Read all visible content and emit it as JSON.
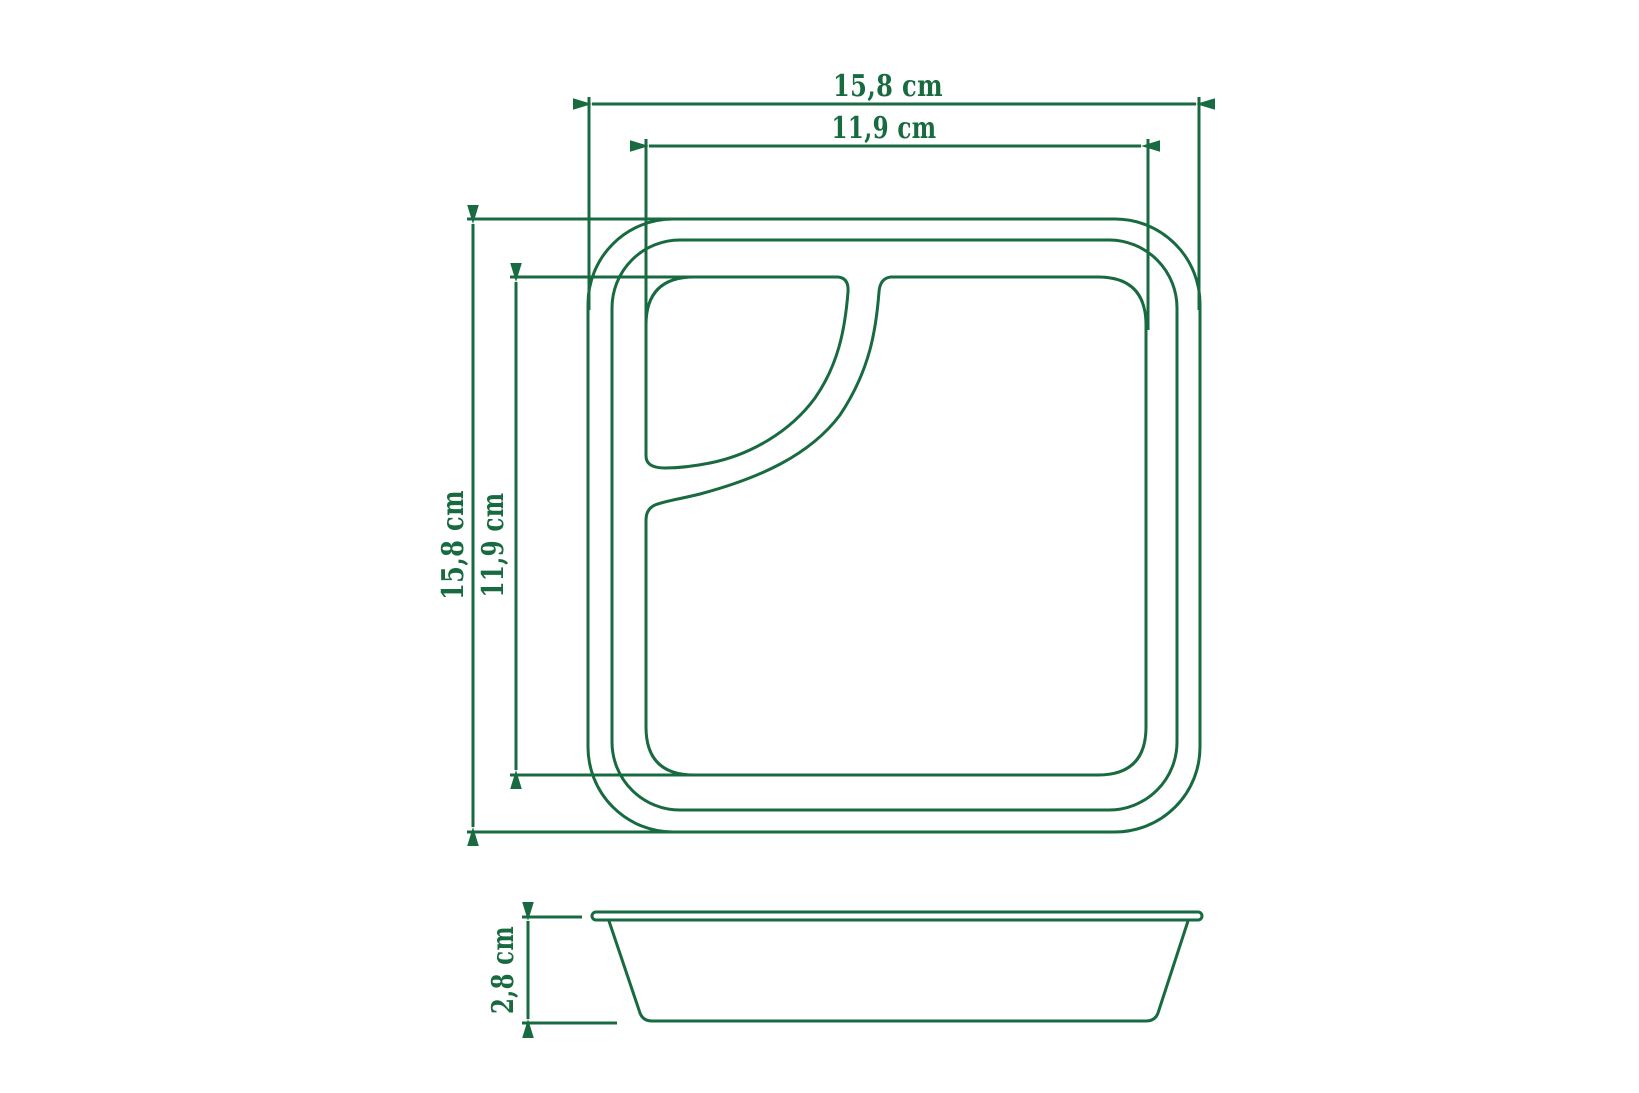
{
  "accent_color": "#186a40",
  "top_view": {
    "outer_width_label": "15,8 cm",
    "inner_width_label": "11,9 cm",
    "outer_height_label": "15,8 cm",
    "inner_height_label": "11,9 cm"
  },
  "side_view": {
    "height_label": "2,8 cm"
  }
}
